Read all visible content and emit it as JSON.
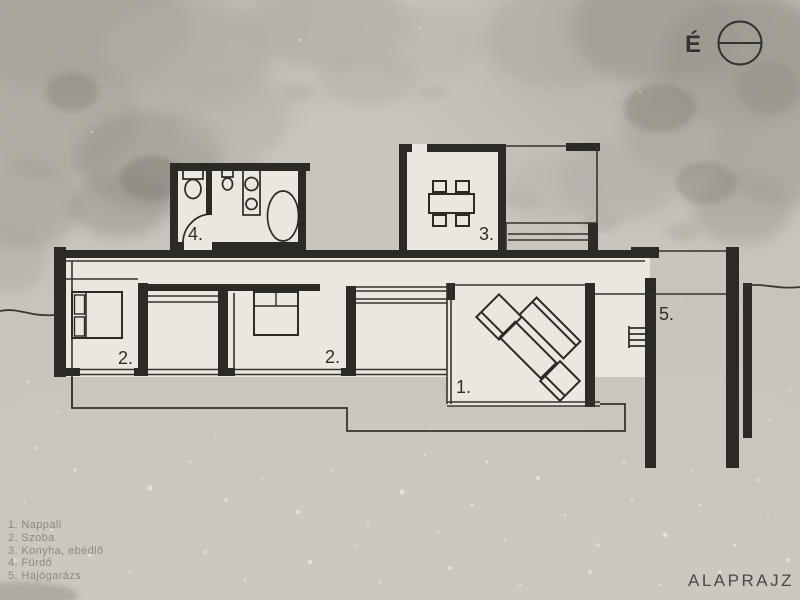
{
  "north": {
    "label": "É"
  },
  "title": "ALAPRAJZ",
  "legend": {
    "items": [
      {
        "text": "1. Nappali"
      },
      {
        "text": "2. Szoba"
      },
      {
        "text": "3. Konyha, ebédlő"
      },
      {
        "text": "4. Fürdő"
      },
      {
        "text": "5. Hajógarázs"
      }
    ]
  },
  "plan": {
    "labels": {
      "living": "1.",
      "bedroom_left": "2.",
      "bedroom_middle": "2.",
      "kitchen_dining": "3.",
      "bathroom": "4.",
      "boat_garage": "5."
    }
  },
  "colors": {
    "ink": "#2b2a25",
    "thin_ink": "#35332d",
    "paper": "#eae7e0",
    "background": "#c7c4bd",
    "legend_text": "#8b8881",
    "title_text": "#4b4945"
  }
}
